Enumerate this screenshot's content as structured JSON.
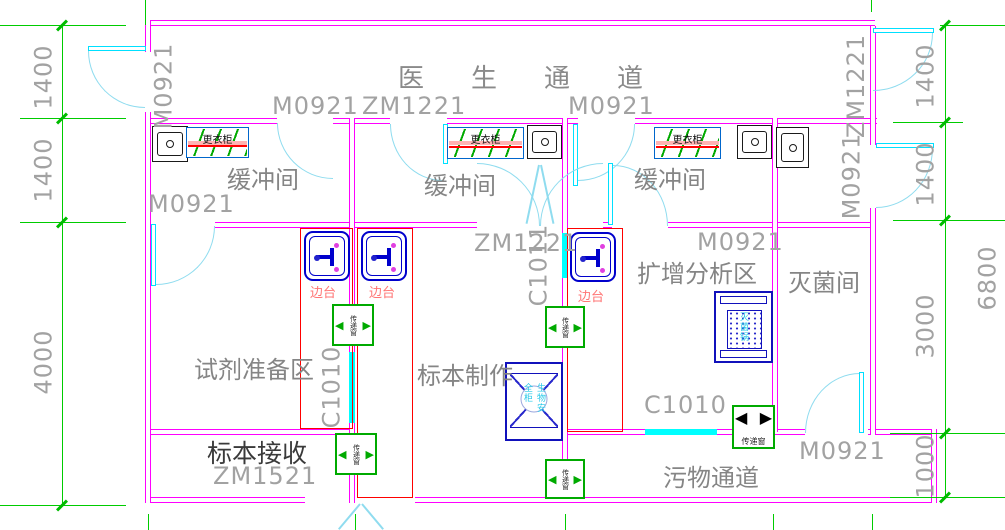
{
  "rooms": {
    "doctor_corridor": "医生通道",
    "buffer_1": "缓冲间",
    "buffer_2": "缓冲间",
    "buffer_3": "缓冲间",
    "reagent_prep": "试剂准备区",
    "specimen_making": "标本制作",
    "amplification_analysis": "扩增分析区",
    "sterilization_room": "灭菌间",
    "specimen_receiving": "标本接收",
    "waste_corridor": "污物通道"
  },
  "codes": {
    "top_left_vert": "M0921",
    "buffer1_top": "M0921",
    "buffer2_top": "ZM1221",
    "buffer3_top": "M0921",
    "top_right_vert": "ZM1221",
    "right_door_vert": "M0921",
    "buffer1_side": "M0921",
    "center_double_door": "ZM1221",
    "center_window_vert": "C1011",
    "amplification_door": "M0921",
    "left_window_vert": "C1010",
    "bottom_window": "C1010",
    "waste_door": "M0921",
    "receiving_door": "ZM1521"
  },
  "dims": {
    "left": [
      "1400",
      "1400",
      "4000"
    ],
    "right": [
      "1400",
      "1400",
      "3000",
      "1000"
    ],
    "overall": "6800"
  },
  "equipment": {
    "wardrobe": "更衣柜",
    "side_bench": "边台",
    "pass_window": "传递窗",
    "biosafety_cabinet": "生物安全柜",
    "sterilizer": "灭菌锅"
  },
  "icons": {
    "pass_arrow_left": "◀",
    "pass_arrow_right": "▶"
  },
  "colors": {
    "wall": "#FF00FF",
    "door_window": "#00E0FF",
    "dimension_line": "#00CC00",
    "bench_outline": "#FF0000",
    "equipment_blue": "#1111BB",
    "pass_window_green": "#00AA00",
    "label_gray": "#9B9B9B"
  }
}
